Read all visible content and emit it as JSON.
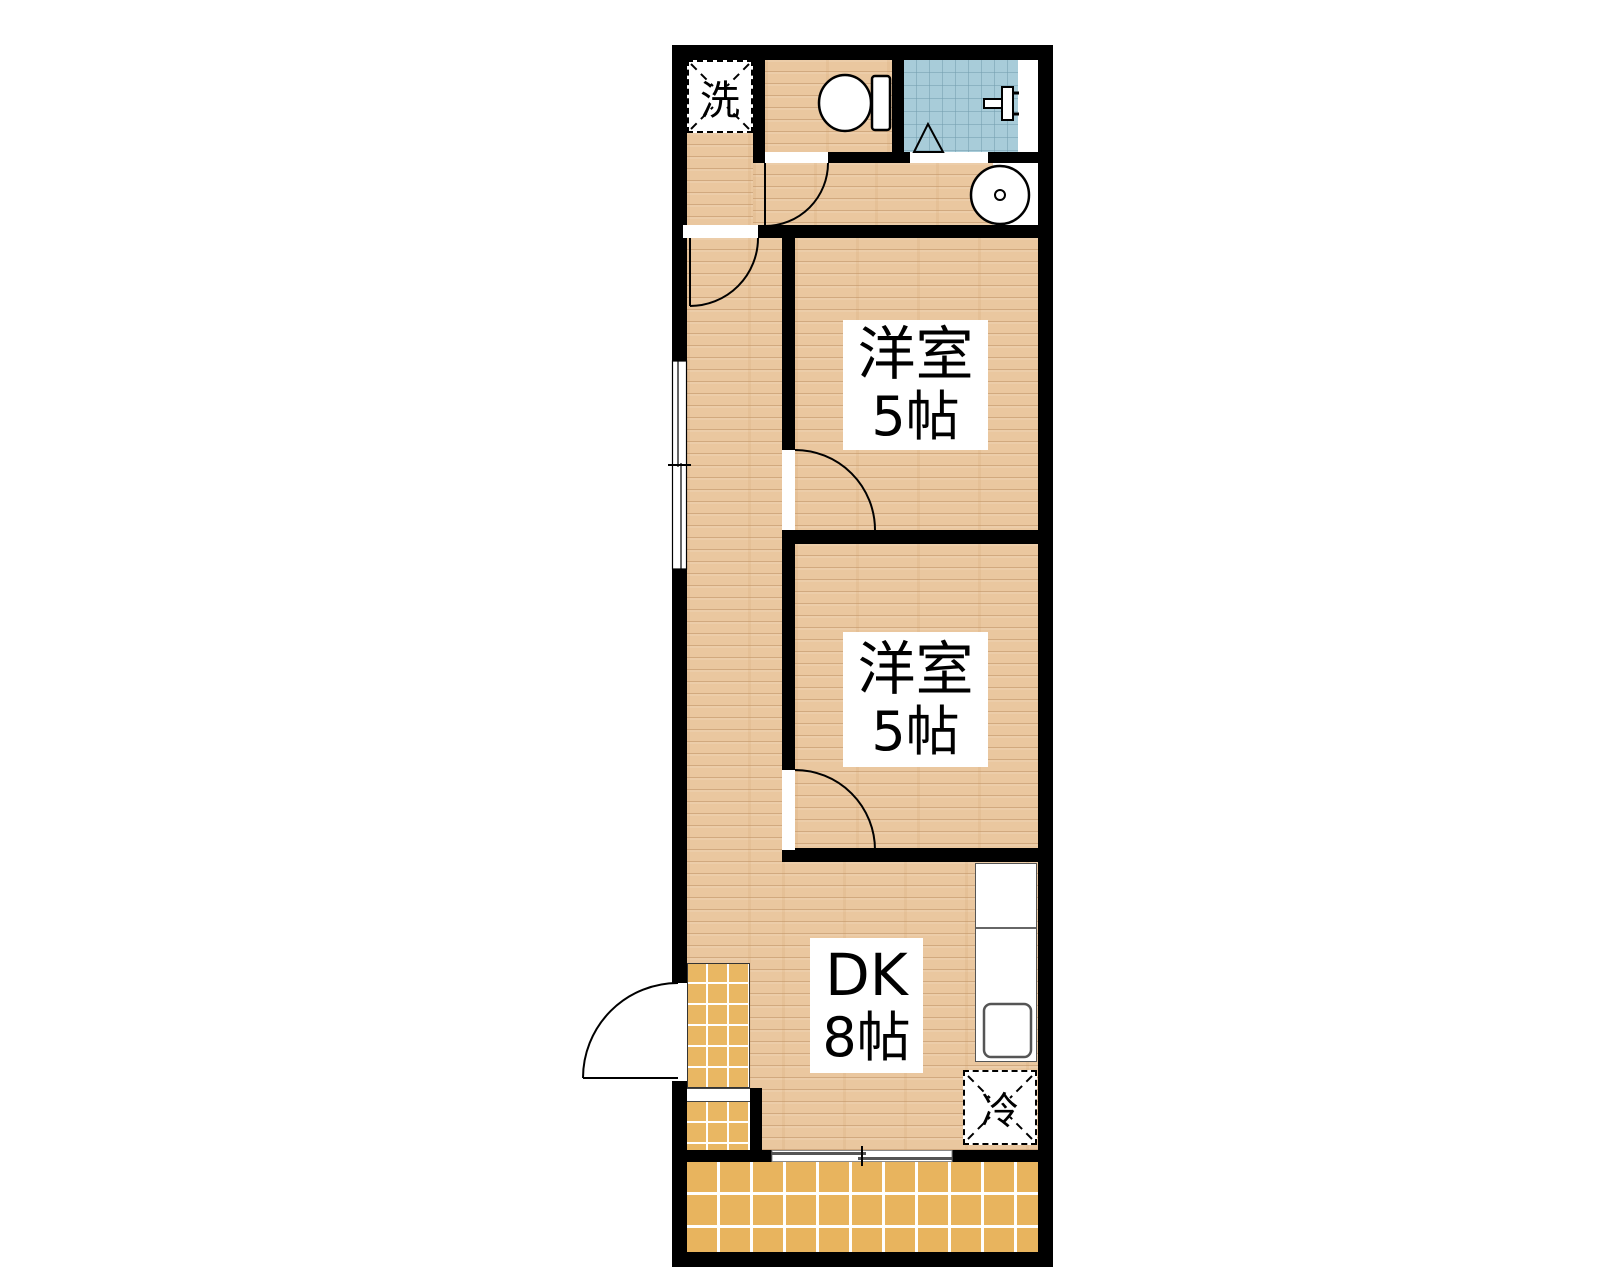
{
  "floorplan": {
    "labels": {
      "washer_space": "洗",
      "room1": {
        "name": "洋室",
        "size": "5帖"
      },
      "room2": {
        "name": "洋室",
        "size": "5帖"
      },
      "dk": {
        "name": "DK",
        "size": "8帖"
      },
      "refrigerator": "冷"
    },
    "colors": {
      "wall": "#000000",
      "wood_floor": "#eac79f",
      "entry_tile": "#e9b763",
      "balcony_tile": "#e8b45e",
      "bath_tile": "#a8ccd9",
      "fixture_white": "#ffffff"
    },
    "icons": {
      "toilet": "toilet-icon",
      "shower_faucet": "faucet-icon",
      "washbasin": "washbasin-icon",
      "bath_door": "folding-door-triangle-icon",
      "room_doors": "door-swing-arc",
      "windows": "sliding-window"
    }
  }
}
